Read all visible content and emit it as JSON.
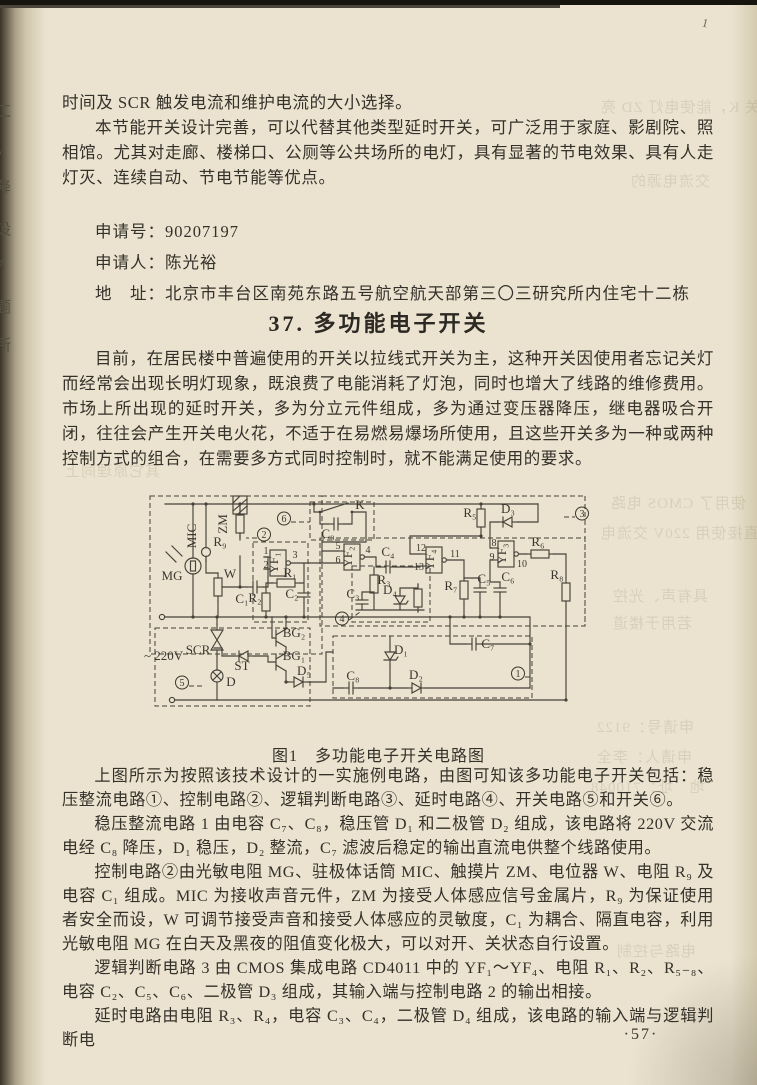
{
  "page": {
    "number": "·57·",
    "corner_mark": "1"
  },
  "margin": {
    "chars": [
      {
        "t": "工",
        "y": 100
      },
      {
        "t": "，",
        "y": 138
      },
      {
        "t": "降",
        "y": 176
      },
      {
        "t": "设",
        "y": 218
      },
      {
        "t": "7",
        "y": 258
      },
      {
        "t": "题",
        "y": 296
      },
      {
        "t": "所",
        "y": 334
      }
    ]
  },
  "intro": {
    "p1": "时间及 SCR 触发电流和维护电流的大小选择。",
    "p2": "本节能开关设计完善，可以代替其他类型延时开关，可广泛用于家庭、影剧院、照相馆。尤其对走廊、楼梯口、公厕等公共场所的电灯，具有显著的节电效果、具有人走灯灭、连续自动、节电节能等优点。"
  },
  "application": {
    "number_label": "申请号：",
    "number": "90207197",
    "applicant_label": "申请人：",
    "applicant": "陈光裕",
    "address_label": "地　址：",
    "address": "北京市丰台区南苑东路五号航空航天部第三〇三研究所内住宅十二栋"
  },
  "section": {
    "heading": "37. 多功能电子开关",
    "p1": "目前，在居民楼中普遍使用的开关以拉线式开关为主，这种开关因使用者忘记关灯而经常会出现长明灯现象，既浪费了电能消耗了灯泡，同时也增大了线路的维修费用。市场上所出现的延时开关，多为分立元件组成，多为通过变压器降压，继电器吸合开闭，往往会产生开关电火花，不适于在易燃易爆场所使用，且这些开关多为一种或两种控制方式的组合，在需要多方式同时控制时，就不能满足使用的要求。"
  },
  "figure": {
    "caption": "图1　多功能电子开关电路图",
    "labels": [
      {
        "t": "~ 220V",
        "x": 74,
        "y": 168,
        "anchor": "start"
      },
      {
        "t": "MIC",
        "x": 126,
        "y": 44,
        "r": -90
      },
      {
        "t": "ZM",
        "x": 157,
        "y": 32,
        "r": -90
      },
      {
        "t": "R₉",
        "x": 150,
        "y": 54
      },
      {
        "t": "MG",
        "x": 102,
        "y": 88
      },
      {
        "t": "W",
        "x": 160,
        "y": 86
      },
      {
        "t": "C₁",
        "x": 172,
        "y": 111
      },
      {
        "t": "2",
        "x": 194,
        "y": 46,
        "circ": true
      },
      {
        "t": "YF₁",
        "x": 208,
        "y": 71,
        "r": -90
      },
      {
        "t": "1",
        "x": 196,
        "y": 62,
        "small": true
      },
      {
        "t": "2",
        "x": 196,
        "y": 76,
        "small": true
      },
      {
        "t": "3",
        "x": 225,
        "y": 66,
        "small": true
      },
      {
        "t": "R₁",
        "x": 220,
        "y": 85
      },
      {
        "t": "R₂",
        "x": 185,
        "y": 110
      },
      {
        "t": "C₂",
        "x": 222,
        "y": 106
      },
      {
        "t": "6",
        "x": 214,
        "y": 30,
        "circ": true
      },
      {
        "t": "K",
        "x": 290,
        "y": 17
      },
      {
        "t": "C₉",
        "x": 258,
        "y": 46
      },
      {
        "t": "YF₂",
        "x": 282,
        "y": 65,
        "r": -90
      },
      {
        "t": "5",
        "x": 268,
        "y": 57,
        "small": true
      },
      {
        "t": "6",
        "x": 268,
        "y": 71,
        "small": true
      },
      {
        "t": "4",
        "x": 298,
        "y": 61,
        "small": true
      },
      {
        "t": "C₄",
        "x": 318,
        "y": 64
      },
      {
        "t": "R₃",
        "x": 314,
        "y": 92
      },
      {
        "t": "C₃",
        "x": 283,
        "y": 106
      },
      {
        "t": "D₄",
        "x": 320,
        "y": 102
      },
      {
        "t": "4",
        "x": 272,
        "y": 130,
        "circ": true
      },
      {
        "t": "YF₄",
        "x": 364,
        "y": 68,
        "r": -90
      },
      {
        "t": "12",
        "x": 351,
        "y": 59,
        "small": true
      },
      {
        "t": "13",
        "x": 349,
        "y": 78,
        "small": true
      },
      {
        "t": "11",
        "x": 385,
        "y": 65,
        "small": true
      },
      {
        "t": "R₇",
        "x": 381,
        "y": 98
      },
      {
        "t": "C₅",
        "x": 414,
        "y": 91
      },
      {
        "t": "C₆",
        "x": 438,
        "y": 89
      },
      {
        "t": "R₅",
        "x": 400,
        "y": 25
      },
      {
        "t": "D₃",
        "x": 438,
        "y": 21
      },
      {
        "t": "YF₃",
        "x": 436,
        "y": 62,
        "r": -90
      },
      {
        "t": "8",
        "x": 424,
        "y": 54,
        "small": true
      },
      {
        "t": "9",
        "x": 422,
        "y": 68,
        "small": true
      },
      {
        "t": "10",
        "x": 452,
        "y": 75,
        "small": true
      },
      {
        "t": "R₆",
        "x": 468,
        "y": 54
      },
      {
        "t": "R₈",
        "x": 487,
        "y": 87
      },
      {
        "t": "C₇",
        "x": 418,
        "y": 156
      },
      {
        "t": "3",
        "x": 512,
        "y": 25,
        "circ": true
      },
      {
        "t": "1",
        "x": 448,
        "y": 185,
        "circ": true
      },
      {
        "t": "5",
        "x": 112,
        "y": 194,
        "circ": true
      },
      {
        "t": "SCR",
        "x": 128,
        "y": 162
      },
      {
        "t": "ST",
        "x": 172,
        "y": 178
      },
      {
        "t": "D",
        "x": 161,
        "y": 194
      },
      {
        "t": "BG₂",
        "x": 224,
        "y": 145
      },
      {
        "t": "BG₁",
        "x": 224,
        "y": 168
      },
      {
        "t": "D₅",
        "x": 234,
        "y": 183
      },
      {
        "t": "C₈",
        "x": 283,
        "y": 188
      },
      {
        "t": "D₁",
        "x": 331,
        "y": 162
      },
      {
        "t": "D₂",
        "x": 346,
        "y": 187
      }
    ]
  },
  "body": {
    "p1": "上图所示为按照该技术设计的一实施例电路，由图可知该多功能电子开关包括：稳压整流电路①、控制电路②、逻辑判断电路③、延时电路④、开关电路⑤和开关⑥。",
    "p2": "稳压整流电路 1 由电容 C₇、C₈，稳压管 D₁ 和二极管 D₂ 组成，该电路将 220V 交流电经 C₈ 降压，D₁ 稳压，D₂ 整流，C₇ 滤波后稳定的输出直流电供整个线路使用。",
    "p3": "控制电路②由光敏电阻 MG、驻极体话筒 MIC、触摸片 ZM、电位器 W、电阻 R₉ 及电容 C₁ 组成。MIC 为接收声音元件，ZM 为接受人体感应信号金属片，R₉ 为保证使用者安全而设，W 可调节接受声音和接受人体感应的灵敏度，C₁ 为耦合、隔直电容，利用光敏电阻 MG 在白天及黑夜的阻值变化极大，可以对开、关状态自行设置。",
    "p4": "逻辑判断电路 3 由 CMOS 集成电路 CD4011 中的 YF₁～YF₄、电阻 R₁、R₂、R₅₋₈、电容 C₂、C₅、C₆、二极管 D₃ 组成，其输入端与控制电路 2 的输出相接。",
    "p5": "延时电路由电阻 R₃、R₄，电容 C₃、C₄，二极管 D₄ 组成，该电路的输入端与逻辑判断电"
  },
  "bleedthrough": {
    "lines": [
      {
        "t": "开关 K，能使电灯 ZD 亮",
        "x": 600,
        "y": 96
      },
      {
        "t": "交流电源的",
        "x": 630,
        "y": 170
      },
      {
        "t": "其它原理同上",
        "x": 64,
        "y": 460
      },
      {
        "t": "使用了 CMOS 电路",
        "x": 610,
        "y": 492
      },
      {
        "t": "直接使用 220V 交流电",
        "x": 600,
        "y": 522
      },
      {
        "t": "具有声、光控",
        "x": 612,
        "y": 585
      },
      {
        "t": "若用于楼道",
        "x": 612,
        "y": 612
      },
      {
        "t": "申请号：9122",
        "x": 596,
        "y": 716
      },
      {
        "t": "申请人：李全",
        "x": 596,
        "y": 746
      },
      {
        "t": "地　址：710048",
        "x": 590,
        "y": 776
      },
      {
        "t": "电路与控制",
        "x": 616,
        "y": 940
      }
    ]
  }
}
